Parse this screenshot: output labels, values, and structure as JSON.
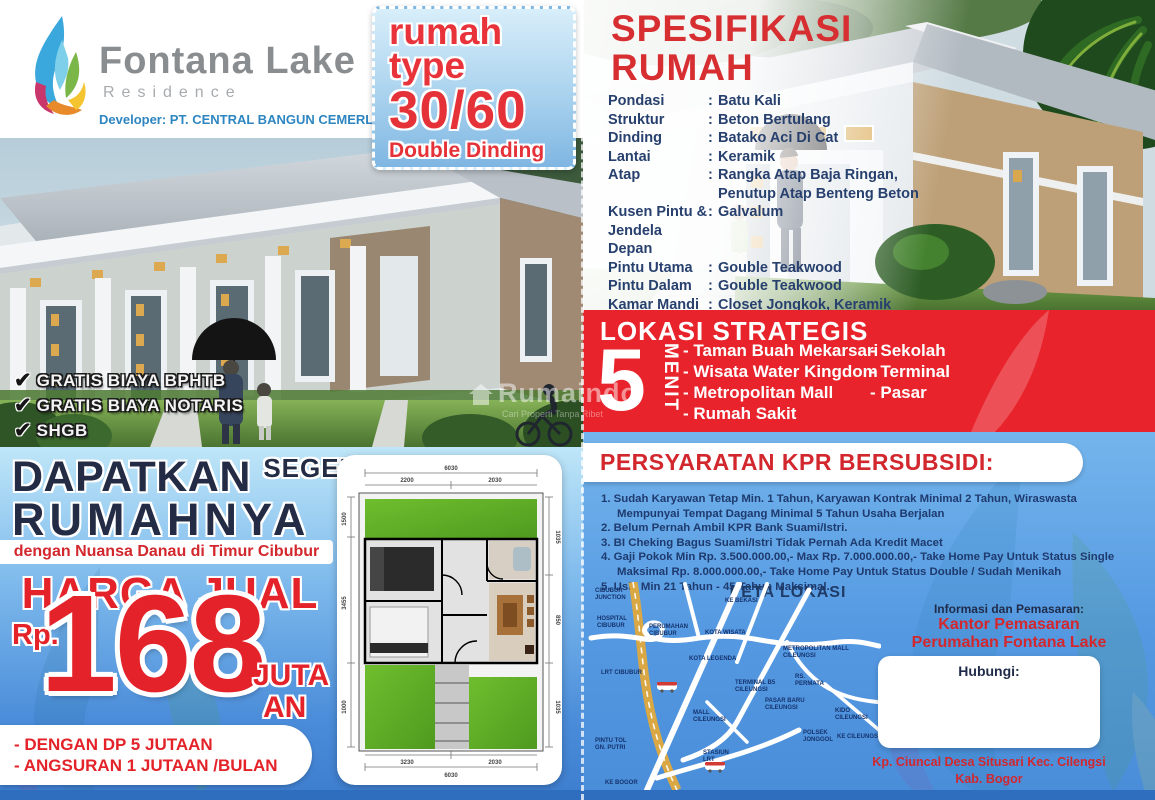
{
  "brand": {
    "name": "Fontana Lake",
    "sub": "Residence",
    "developer": "Developer: PT. CENTRAL BANGUN CEMERLANG"
  },
  "badge": {
    "word1": "rumah",
    "word2": "type",
    "size": "30/60",
    "note": "Double Dinding"
  },
  "benefits": [
    "GRATIS BIAYA BPHTB",
    "GRATIS BIAYA NOTARIS",
    "SHGB"
  ],
  "promo": {
    "get": "DAPATKAN",
    "soon": "SEGERA",
    "house": "RUMAHNYA",
    "tagline": "dengan Nuansa Danau di Timur Cibubur",
    "price_title": "HARGA JUAL",
    "currency": "Rp.",
    "price": "168",
    "unit_top": "JUTA",
    "unit_bottom": "AN",
    "terms": [
      "- DENGAN DP 5 JUTAAN",
      "- ANGSURAN 1 JUTAAN /BULAN"
    ]
  },
  "spec": {
    "title": "SPESIFIKASI\nRUMAH",
    "rows": [
      {
        "label": "Pondasi",
        "value": "Batu Kali"
      },
      {
        "label": "Struktur",
        "value": "Beton Bertulang"
      },
      {
        "label": "Dinding",
        "value": "Batako Aci Di Cat"
      },
      {
        "label": "Lantai",
        "value": "Keramik"
      },
      {
        "label": "Atap",
        "value": "Rangka Atap Baja Ringan,\nPenutup Atap Benteng Beton"
      },
      {
        "label": "Kusen Pintu &\nJendela Depan",
        "value": "Galvalum"
      },
      {
        "label": "Pintu Utama",
        "value": "Gouble Teakwood"
      },
      {
        "label": "Pintu Dalam",
        "value": "Gouble Teakwood"
      },
      {
        "label": "Kamar Mandi",
        "value": "Closet Jongkok, Keramik"
      },
      {
        "label": "Sumber Air",
        "value": "Sumur Pantek"
      },
      {
        "label": "Listrik",
        "value": "900w / 1.300w\n(sesuai ketentuan dari PLN)"
      }
    ]
  },
  "location": {
    "title": "LOKASI STRATEGIS",
    "minutes": "5",
    "unit": "MENIT",
    "col1": [
      "- Taman Buah Mekarsari",
      "- Wisata Water Kingdom",
      "- Metropolitan Mall",
      "- Rumah Sakit"
    ],
    "col2": [
      "- Sekolah",
      "- Terminal",
      "- Pasar"
    ]
  },
  "kpr": {
    "title": "PERSYARATAN KPR BERSUBSIDI:",
    "items": [
      "1. Sudah Karyawan Tetap Min. 1 Tahun, Karyawan Kontrak Minimal 2 Tahun, Wiraswasta Mempunyai Tempat Dagang Minimal 5 Tahun Usaha Berjalan",
      "2. Belum Pernah Ambil KPR Bank Suami/Istri.",
      "3. BI Cheking Bagus Suami/Istri Tidak Pernah Ada Kredit Macet",
      "4. Gaji Pokok Min Rp. 3.500.000.00,- Max Rp. 7.000.000.00,- Take Home Pay Untuk Status Single Maksimal Rp. 8.000.000.00,- Take Home Pay Untuk Status Double / Sudah Menikah",
      "5. Usia Min 21 Tahun - 45 Tahun Maksimal."
    ]
  },
  "map": {
    "title": "PETA LOKASI",
    "labels": [
      "CIBUBUR\nJUNCTION",
      "HOSPITAL\nCIBUBUR",
      "PERUMAHAN\nCIBUBUR",
      "KE BEKASI",
      "KOTA WISATA",
      "KOTA LEGENDA",
      "METROPOLITAN MALL\nCILEUNGSI",
      "RS.\nPERMATA",
      "TERMINAL B5\nCILEUNGSI",
      "PASAR BARU\nCILEUNGSI",
      "MALL\nCILEUNGSI",
      "LRT CIBUBUR",
      "PINTU TOL\nGN. PUTRI",
      "KIDO\nCILEUNGSI",
      "KE CILEUNGSI",
      "POLSEK\nJONGGOL",
      "STASIUN\nLRT",
      "KE BOGOR"
    ]
  },
  "contact": {
    "info_label": "Informasi dan Pemasaran:",
    "office1": "Kantor Pemasaran",
    "office2": "Perumahan Fontana Lake",
    "contact_label": "Hubungi:",
    "address1": "Kp. Ciuncal Desa Situsari Kec. Cilengsi",
    "address2": "Kab. Bogor"
  },
  "floorplan": {
    "top_total": "6030",
    "top_left": "2200",
    "top_right": "2030",
    "bottom_left": "3230",
    "bottom_right": "2030",
    "bottom_total": "6030",
    "left1": "1500",
    "left2": "3455",
    "left3": "1000",
    "right1": "1035",
    "right2": "850",
    "right3": "1035"
  },
  "watermark": {
    "name": "Rumaindo",
    "tagline": "Cari Properti Tanpa Ribet"
  },
  "colors": {
    "red": "#e32329",
    "band_red": "#e8232b",
    "navy": "#1f2b49",
    "spec_navy": "#27406e",
    "dev_blue": "#2e86c1"
  }
}
